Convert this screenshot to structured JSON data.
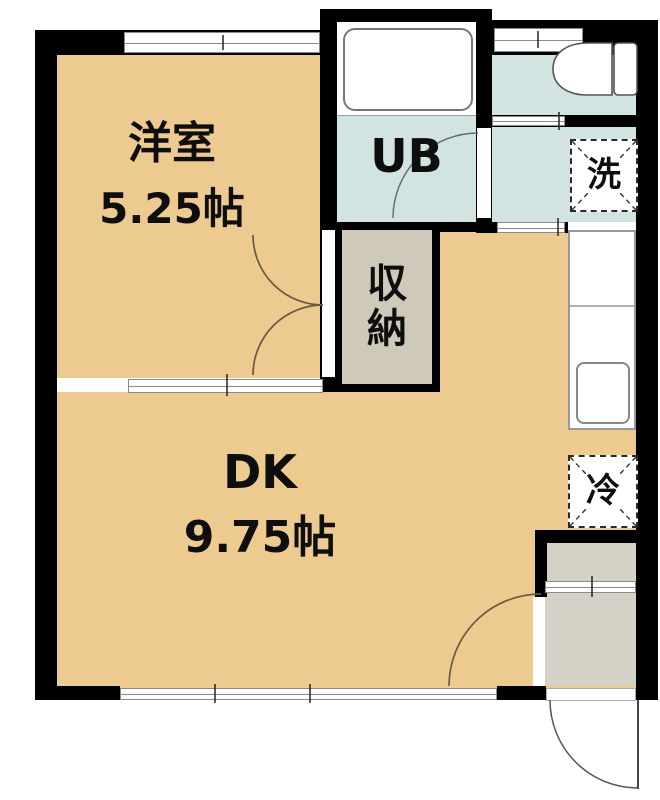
{
  "plan": {
    "type": "apartment-floor-plan",
    "rooms": {
      "western_room": {
        "name": "洋室",
        "size": "5.25帖"
      },
      "dining_kitchen": {
        "name": "DK",
        "size": "9.75帖"
      },
      "unit_bath": {
        "label": "UB"
      },
      "storage": {
        "label": "収納"
      },
      "laundry_space": {
        "label": "洗"
      },
      "refrigerator_space": {
        "label": "冷"
      }
    },
    "colors": {
      "room_floor_tan": "#ecca90",
      "wet_area_blue": "#d2e4e2",
      "storage_fill": "#cfc9ba",
      "entry_fill": "#d4d1c6",
      "wall": "#000000",
      "fixture_stroke": "#777777"
    },
    "fixtures": [
      "bathtub",
      "toilet",
      "kitchen-counter",
      "kitchen-sink",
      "washer-space",
      "refrigerator-space",
      "entry-door"
    ]
  }
}
